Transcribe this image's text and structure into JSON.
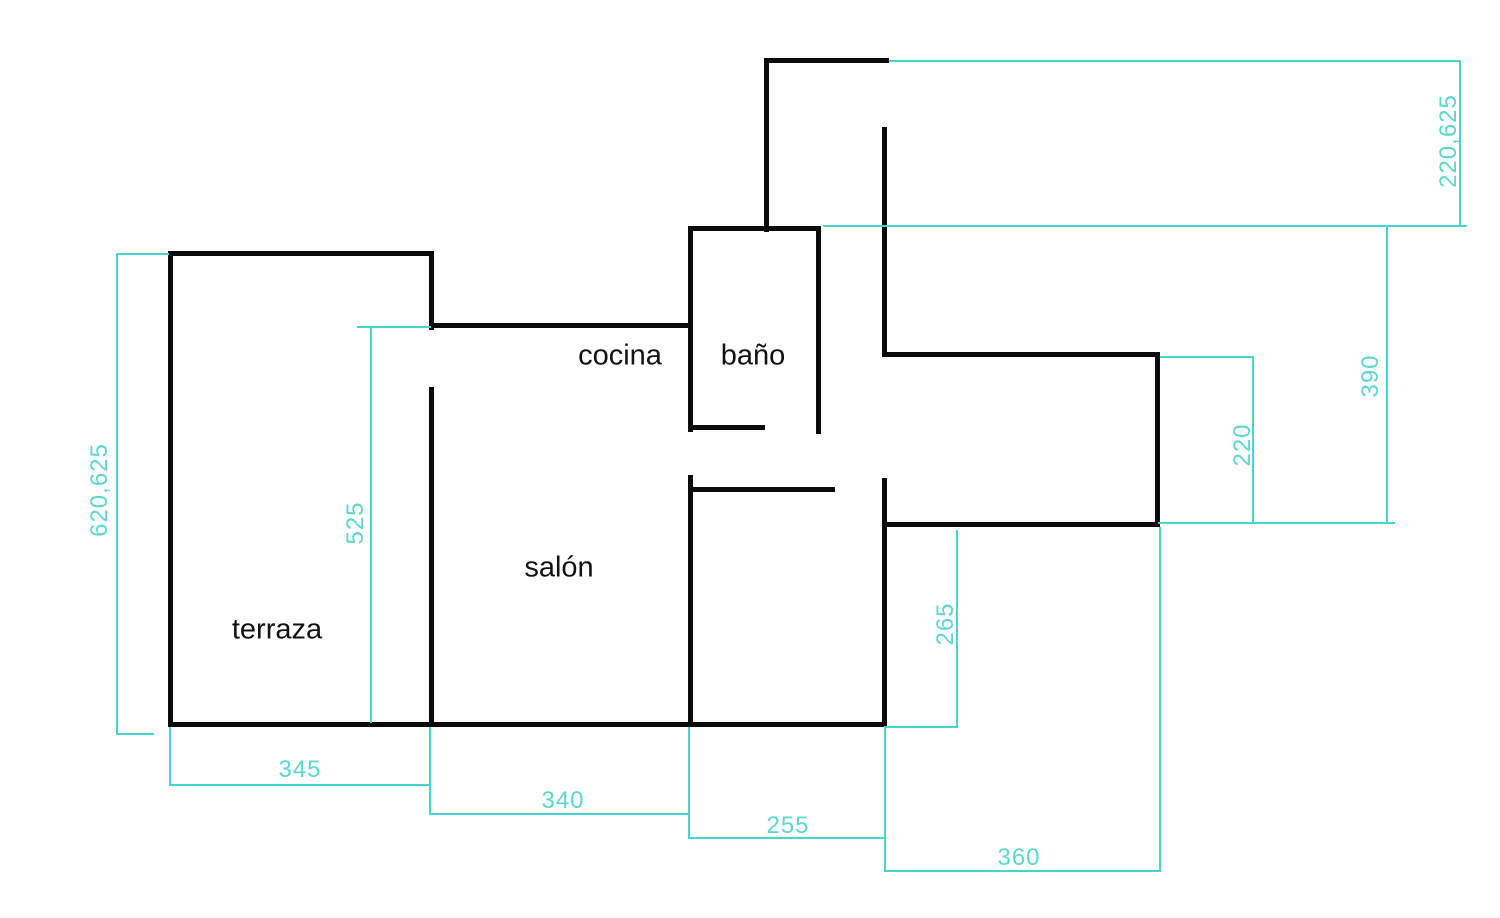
{
  "page": {
    "width": 1500,
    "height": 918,
    "background": "#ffffff"
  },
  "colors": {
    "wall": "#0b0b0b",
    "dimension_line": "#45d7cf",
    "dimension_text": "#5cd7d0",
    "room_text": "#111111"
  },
  "rooms": [
    {
      "id": "cocina",
      "label": "cocina",
      "x": 620,
      "y": 356
    },
    {
      "id": "bano",
      "label": "baño",
      "x": 753,
      "y": 356
    },
    {
      "id": "salon",
      "label": "salón",
      "x": 559,
      "y": 568
    },
    {
      "id": "terraza",
      "label": "terraza",
      "x": 277,
      "y": 630
    }
  ],
  "walls": [
    {
      "x": 764,
      "y": 58,
      "w": 125,
      "h": 5
    },
    {
      "x": 764,
      "y": 58,
      "w": 5,
      "h": 174
    },
    {
      "x": 882,
      "y": 127,
      "w": 5,
      "h": 230
    },
    {
      "x": 688,
      "y": 226,
      "w": 133,
      "h": 5
    },
    {
      "x": 688,
      "y": 226,
      "w": 5,
      "h": 206
    },
    {
      "x": 816,
      "y": 226,
      "w": 5,
      "h": 208
    },
    {
      "x": 688,
      "y": 425,
      "w": 77,
      "h": 5
    },
    {
      "x": 882,
      "y": 352,
      "w": 278,
      "h": 5
    },
    {
      "x": 1155,
      "y": 352,
      "w": 5,
      "h": 175
    },
    {
      "x": 882,
      "y": 522,
      "w": 278,
      "h": 5
    },
    {
      "x": 882,
      "y": 478,
      "w": 5,
      "h": 249
    },
    {
      "x": 688,
      "y": 475,
      "w": 5,
      "h": 252
    },
    {
      "x": 688,
      "y": 487,
      "w": 147,
      "h": 5
    },
    {
      "x": 168,
      "y": 251,
      "w": 5,
      "h": 476
    },
    {
      "x": 168,
      "y": 251,
      "w": 266,
      "h": 5
    },
    {
      "x": 429,
      "y": 251,
      "w": 5,
      "h": 79
    },
    {
      "x": 429,
      "y": 323,
      "w": 264,
      "h": 5
    },
    {
      "x": 429,
      "y": 387,
      "w": 5,
      "h": 340
    },
    {
      "x": 168,
      "y": 722,
      "w": 719,
      "h": 5
    }
  ],
  "dimensions": {
    "lines": [
      {
        "x": 889,
        "y": 60,
        "w": 572,
        "h": 2
      },
      {
        "x": 1459,
        "y": 60,
        "w": 2,
        "h": 167
      },
      {
        "x": 823,
        "y": 225,
        "w": 644,
        "h": 2
      },
      {
        "x": 1386,
        "y": 226,
        "w": 2,
        "h": 298
      },
      {
        "x": 1158,
        "y": 522,
        "w": 237,
        "h": 2
      },
      {
        "x": 1252,
        "y": 356,
        "w": 2,
        "h": 168
      },
      {
        "x": 1160,
        "y": 356,
        "w": 94,
        "h": 2
      },
      {
        "x": 116,
        "y": 253,
        "w": 2,
        "h": 482
      },
      {
        "x": 116,
        "y": 253,
        "w": 53,
        "h": 2
      },
      {
        "x": 116,
        "y": 733,
        "w": 38,
        "h": 2
      },
      {
        "x": 370,
        "y": 326,
        "w": 2,
        "h": 397
      },
      {
        "x": 357,
        "y": 326,
        "w": 74,
        "h": 2
      },
      {
        "x": 956,
        "y": 530,
        "w": 2,
        "h": 198
      },
      {
        "x": 884,
        "y": 726,
        "w": 74,
        "h": 2
      },
      {
        "x": 169,
        "y": 727,
        "w": 2,
        "h": 59
      },
      {
        "x": 429,
        "y": 727,
        "w": 2,
        "h": 59
      },
      {
        "x": 169,
        "y": 784,
        "w": 262,
        "h": 2
      },
      {
        "x": 429,
        "y": 784,
        "w": 2,
        "h": 31
      },
      {
        "x": 429,
        "y": 813,
        "w": 261,
        "h": 2
      },
      {
        "x": 688,
        "y": 727,
        "w": 2,
        "h": 112
      },
      {
        "x": 688,
        "y": 837,
        "w": 198,
        "h": 2
      },
      {
        "x": 884,
        "y": 727,
        "w": 2,
        "h": 145
      },
      {
        "x": 884,
        "y": 870,
        "w": 277,
        "h": 2
      },
      {
        "x": 1159,
        "y": 527,
        "w": 2,
        "h": 345
      }
    ],
    "labels": [
      {
        "text": "220,625",
        "x": 1449,
        "y": 141,
        "rotated": true
      },
      {
        "text": "390",
        "x": 1371,
        "y": 376,
        "rotated": true
      },
      {
        "text": "220",
        "x": 1243,
        "y": 445,
        "rotated": true
      },
      {
        "text": "620,625",
        "x": 100,
        "y": 490,
        "rotated": true
      },
      {
        "text": "525",
        "x": 356,
        "y": 523,
        "rotated": true
      },
      {
        "text": "265",
        "x": 946,
        "y": 624,
        "rotated": true
      },
      {
        "text": "345",
        "x": 300,
        "y": 770,
        "rotated": false
      },
      {
        "text": "340",
        "x": 563,
        "y": 801,
        "rotated": false
      },
      {
        "text": "255",
        "x": 788,
        "y": 826,
        "rotated": false
      },
      {
        "text": "360",
        "x": 1019,
        "y": 858,
        "rotated": false
      }
    ]
  }
}
